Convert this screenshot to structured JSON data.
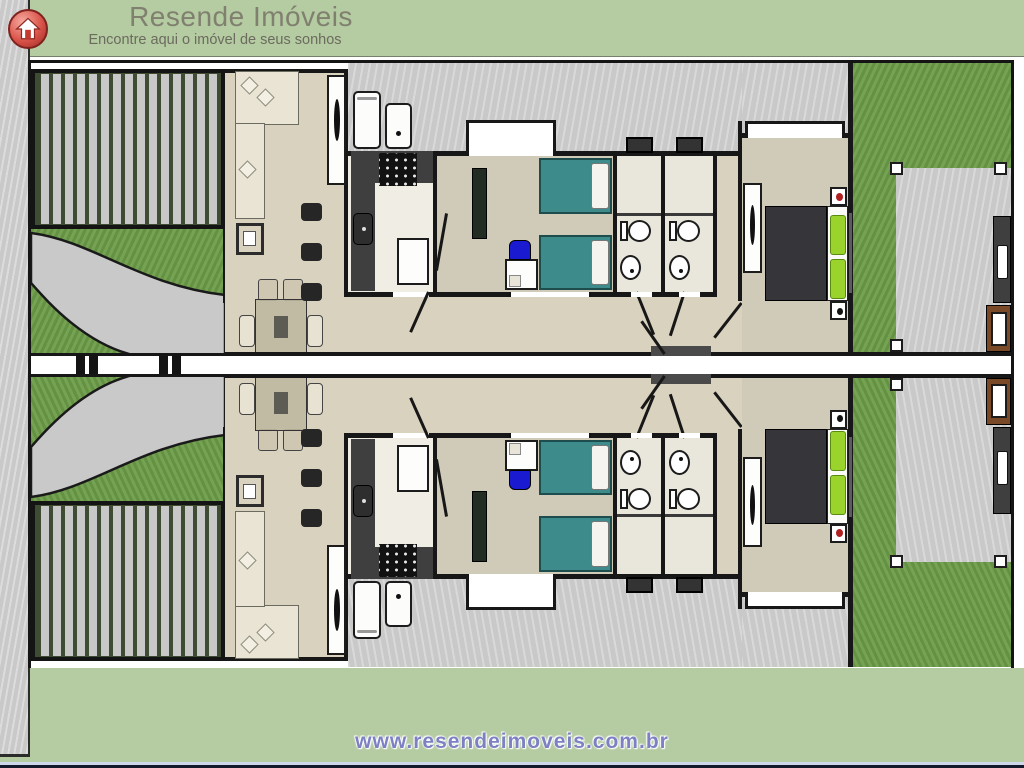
{
  "header": {
    "title": "Resende Imóveis",
    "tagline": "Encontre aqui o imóvel de seus sonhos",
    "logo": "red circle badge with white house-arrow icon"
  },
  "footer": {
    "url": "www.resendeimoveis.com.br"
  },
  "floorplan": {
    "description": "Top-down architectural floor plan of two mirrored twin houses sharing a central dividing line",
    "units": [
      "unit-top",
      "unit-bottom (vertical mirror of unit-top)"
    ],
    "rooms_per_unit": [
      "carport-pergola",
      "driveway-garden",
      "living-dining-room",
      "kitchen",
      "bedroom",
      "bathroom-1",
      "bathroom-2",
      "hallway",
      "master-bedroom",
      "backyard-lawn",
      "backyard-patio-with-barbecue"
    ],
    "furniture": [
      "l-shaped-sofa",
      "side-table",
      "dining-table-4-chairs",
      "bar-stools",
      "kitchen-counter-stove-sink",
      "fridge",
      "water-cooler",
      "island",
      "two-teal-single-beds",
      "desk-blue-chair",
      "wardrobes",
      "toilets",
      "round-sinks",
      "master-double-bed-lime-pillows",
      "nightstands",
      "outdoor-counter",
      "grill"
    ]
  },
  "colors": {
    "brand-green": "#b5cba2",
    "logo-red": "#d9534a",
    "title-gray": "#80806f",
    "tagline-gray": "#6b6b5e",
    "url-blue": "#7d81c4",
    "wall-black": "#171717",
    "concrete": "#c9c9c9",
    "grass": "#6d9c49",
    "floor-beige": "#d8d2bf",
    "floor-room": "#d0cab8",
    "floor-kitchen": "#f0ede4",
    "floor-bath": "#e9e6db",
    "bed-teal": "#3e8b8b",
    "pillow-lime": "#9ad32c",
    "duvet-dark": "#35353a",
    "counter-dark": "#3f3f3f",
    "pergola-green": "#3d4c33",
    "slat-gray": "#c8c8c8",
    "grill-brown": "#7a4a28",
    "sofa-cream": "#eae4d4",
    "chair-tan": "#cfc7b2",
    "chair-blue": "#1a1ad0",
    "accent-red": "#b02020"
  }
}
